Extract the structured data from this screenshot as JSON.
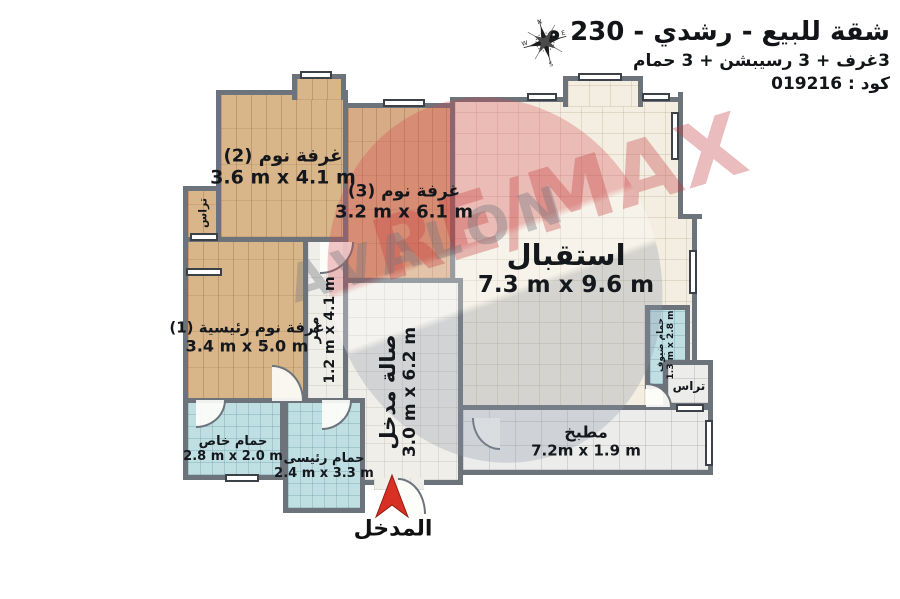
{
  "header": {
    "title": "شقة للبيع - رشدي - 230 م",
    "subtitle": "3غرف + 3 رسيبشن + 3 حمام",
    "code": "كود : 019216"
  },
  "compass": {
    "north": "N",
    "east": "E",
    "south": "S",
    "west": "W"
  },
  "watermark": {
    "brand": "RE/MAX",
    "agency": "AVALON"
  },
  "entrance": {
    "label": "المدخل"
  },
  "rooms": {
    "bedroom2": {
      "name": "غرفة نوم (2)",
      "dims": "3.6 m x 4.1 m"
    },
    "bedroom3": {
      "name": "غرفة نوم (3)",
      "dims": "3.2 m x 6.1 m"
    },
    "reception": {
      "name": "استقبال",
      "dims": "7.3 m x 9.6 m"
    },
    "master": {
      "name": "غرفة نوم رئيسية (1)",
      "dims": "3.4 m x 5.0 m"
    },
    "corridor": {
      "name": "ممر",
      "dims": "1.2 m x 4.1 m"
    },
    "hall": {
      "name": "صالة مدخل",
      "dims": "3.0 m x 6.2 m"
    },
    "kitchen": {
      "name": "مطبخ",
      "dims": "7.2m x 1.9 m"
    },
    "bath_private": {
      "name": "حمام خاص",
      "dims": "2.8 m x 2.0 m"
    },
    "bath_main": {
      "name": "حمام رئيسى",
      "dims": "2.4 m x 3.3 m"
    },
    "bath_guest": {
      "name": "حمام ضيوف",
      "dims": "1.3 m x 2.8 m"
    },
    "terrace_left": {
      "name": "تراس"
    },
    "terrace_right": {
      "name": "تراس"
    }
  },
  "colors": {
    "wall": "#6c737b",
    "wood_floor": "#d9b58a",
    "cream_tile": "#f3eee1",
    "blue_tile": "#bfdfe3",
    "white_tile": "#ececea",
    "entrance_red": "#d93025",
    "watermark_red": "#c43a3e",
    "watermark_gray": "#73757d"
  }
}
